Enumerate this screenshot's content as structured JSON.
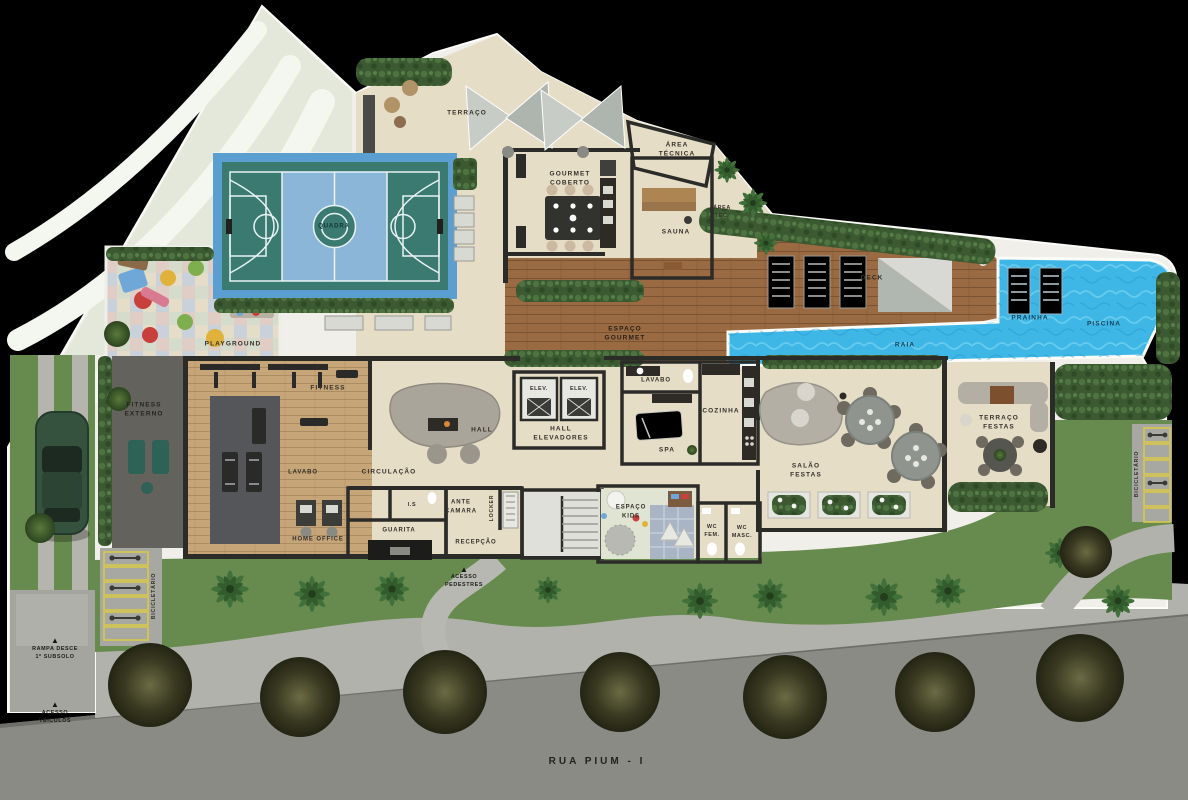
{
  "plan_type": "ground-floor amenities plan",
  "street": {
    "name": "RUA PIUM - I"
  },
  "labels": {
    "terraco": "TERRAÇO",
    "gourmet_coberto": "GOURMET\nCOBERTO",
    "area_tecnica": "ÁREA\nTÉCNICA",
    "sauna": "SAUNA",
    "area_tec": "ÁREA\nTEC.",
    "deck": "DECK",
    "prainha": "PRAINHA",
    "piscina": "PISCINA",
    "raia": "RAIA",
    "espaco_gourmet": "ESPAÇO\nGOURMET",
    "quadra": "QUADRA",
    "playground": "PLAYGROUND",
    "fitness_externo": "FITNESS\nEXTERNO",
    "fitness": "FITNESS",
    "hall": "HALL",
    "elev": "ELEV.",
    "hall_elevadores": "HALL\nELEVADORES",
    "lavabo": "LAVABO",
    "spa": "SPA",
    "cozinha": "COZINHA",
    "salao_festas": "SALÃO\nFESTAS",
    "terraco_festas": "TERRAÇO\nFESTAS",
    "circulacao": "CIRCULAÇÃO",
    "is": "I.S",
    "ante_camara": "ANTE\nCAMARA",
    "locker": "LOCKER",
    "guarita": "GUARITA",
    "home_office": "HOME OFFICE",
    "recepcao": "RECEPÇÃO",
    "espaco_kids": "ESPAÇO\nKIDS",
    "wc_fem": "WC\nFEM.",
    "wc_masc": "WC\nMASC.",
    "acesso_pedestres": "ACESSO\nPEDESTRES",
    "bicicletario": "BICICLETÁRIO",
    "rampa_subsolo": "RAMPA DESCE\n1º SUBSOLO",
    "acesso_veiculos": "ACESSO\nVEÍCULOS"
  },
  "icons": {
    "up_arrow": "▲"
  },
  "colors": {
    "background": "#000000",
    "site": "#f0efe9",
    "wedge": "#e3e8da",
    "floor": "#e6ddc7",
    "wood": "#9a6a42",
    "wood_dark": "#7c5331",
    "fitness_wood": "#c6a578",
    "pool": "#3fb7e6",
    "pool_light": "#8adcf4",
    "court": "#3a7a70",
    "court_paint": "#8cb6d8",
    "court_border": "#5b9fd0",
    "grass": "#678a4e",
    "lawn": "#c9d4b8",
    "hedge": "#3c5a31",
    "hedge_light": "#4e7340",
    "road": "#8b8b86",
    "sidewalk": "#b2b2ac",
    "wall": "#2b2b28",
    "patio": "#63625c",
    "gym_floor": "#55565a",
    "stall_yellow": "#d8c84a",
    "car": "#35523f",
    "label": "#342f29",
    "tile1": "#dfcdc6",
    "tile2": "#d6dccc",
    "tile3": "#c9d2da",
    "tile4": "#e6ddc8"
  }
}
